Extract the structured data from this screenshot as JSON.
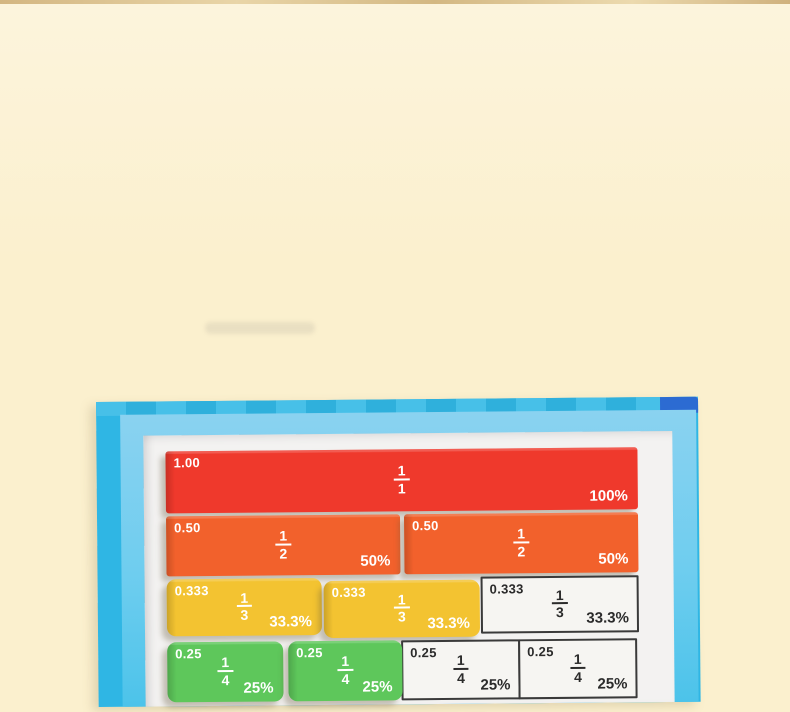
{
  "photo": {
    "background_color": "#FBF0CE",
    "table_edge_color": "#C9A76E"
  },
  "board": {
    "edge_color": "#2FB6E4",
    "mat_color": "#8AD2F0",
    "paper_color": "#F3F2F1",
    "corner_accent_color": "#2C6BD2",
    "checker_colors": [
      "#47C0E8",
      "#2FB0DC"
    ]
  },
  "tiles": {
    "colors": {
      "red": "#EF392C",
      "orange": "#F2612C",
      "yellow": "#F3C331",
      "green": "#5EC75B",
      "printed_bg": "#F6F5F2",
      "printed_border": "#3A3A3A"
    },
    "rows": [
      {
        "cells": [
          {
            "decimal": "1.00",
            "numerator": "1",
            "denominator": "1",
            "percent": "100%"
          }
        ]
      },
      {
        "cells": [
          {
            "decimal": "0.50",
            "numerator": "1",
            "denominator": "2",
            "percent": "50%"
          },
          {
            "decimal": "0.50",
            "numerator": "1",
            "denominator": "2",
            "percent": "50%"
          }
        ]
      },
      {
        "cells": [
          {
            "decimal": "0.333",
            "numerator": "1",
            "denominator": "3",
            "percent": "33.3%"
          },
          {
            "decimal": "0.333",
            "numerator": "1",
            "denominator": "3",
            "percent": "33.3%"
          },
          {
            "decimal": "0.333",
            "numerator": "1",
            "denominator": "3",
            "percent": "33.3%"
          }
        ]
      },
      {
        "cells": [
          {
            "decimal": "0.25",
            "numerator": "1",
            "denominator": "4",
            "percent": "25%"
          },
          {
            "decimal": "0.25",
            "numerator": "1",
            "denominator": "4",
            "percent": "25%"
          },
          {
            "decimal": "0.25",
            "numerator": "1",
            "denominator": "4",
            "percent": "25%"
          },
          {
            "decimal": "0.25",
            "numerator": "1",
            "denominator": "4",
            "percent": "25%"
          }
        ]
      }
    ]
  }
}
